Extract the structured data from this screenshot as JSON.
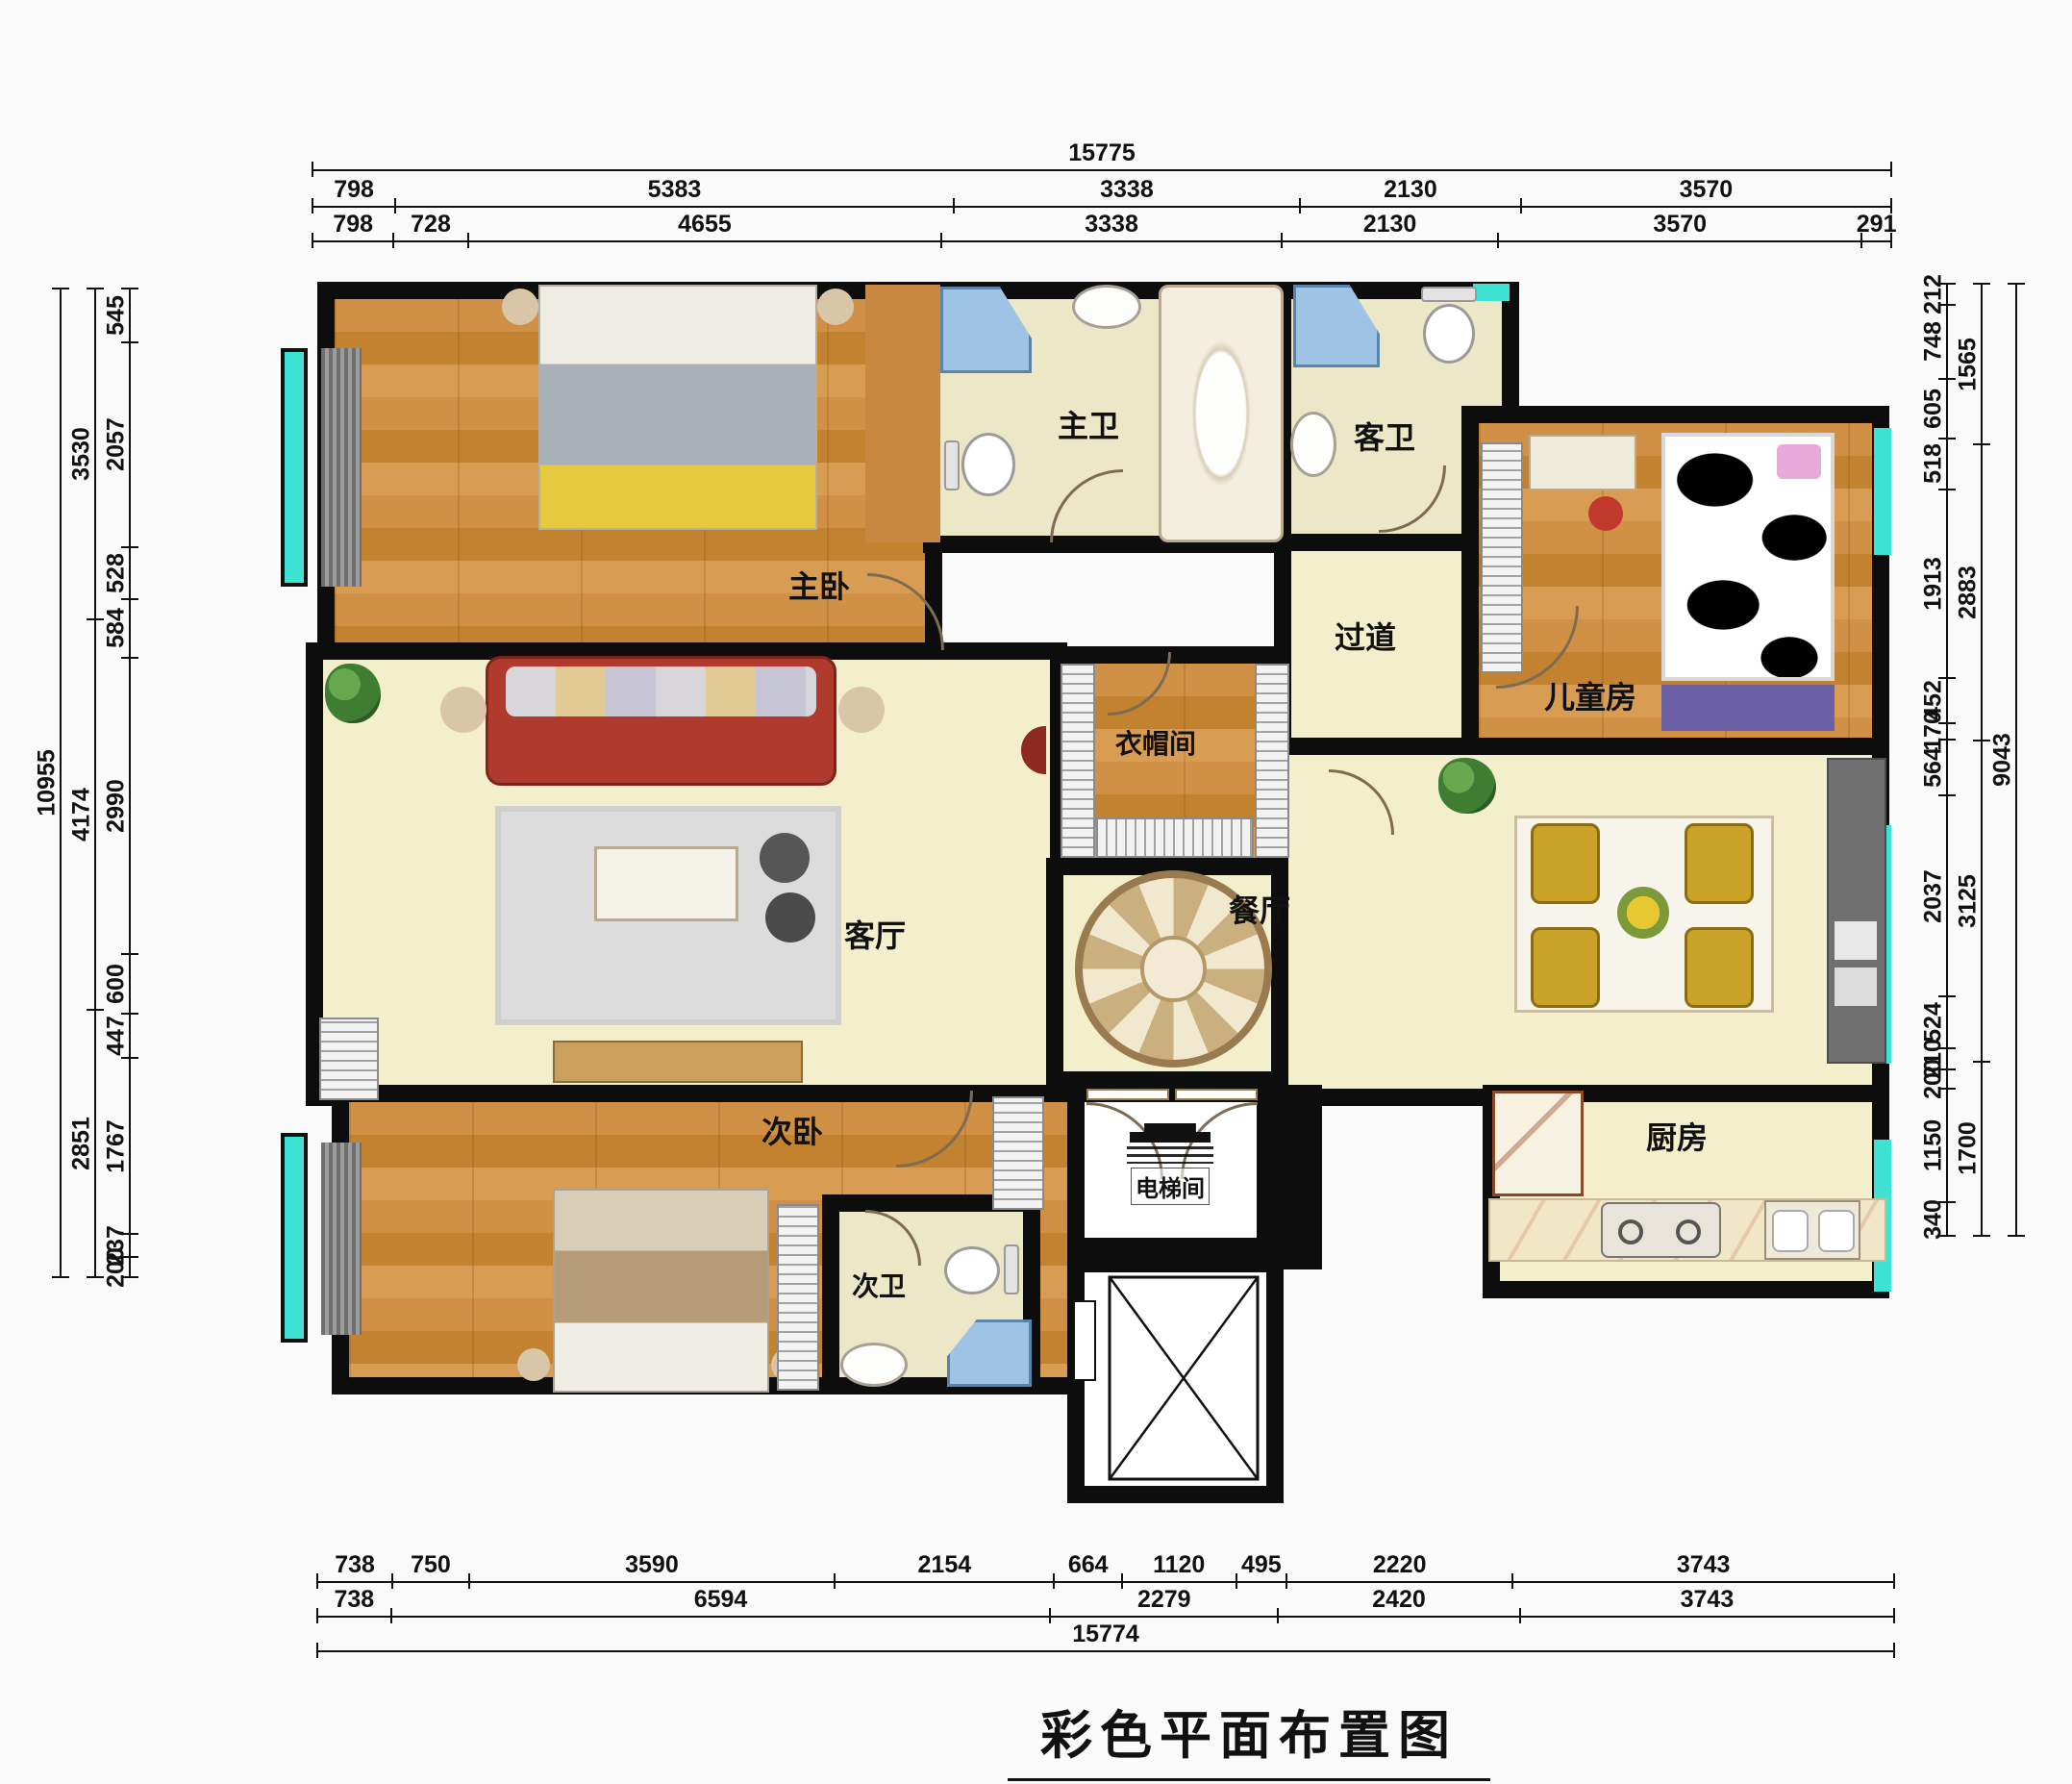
{
  "title": "彩色平面布置图",
  "rooms": {
    "master_bedroom": "主卧",
    "master_bath": "主卫",
    "guest_bath": "客卫",
    "hallway": "过道",
    "children_room": "儿童房",
    "cloakroom": "衣帽间",
    "living_room": "客厅",
    "dining_room": "餐厅",
    "second_bedroom": "次卧",
    "second_bath": "次卫",
    "kitchen": "厨房",
    "elevator_room": "电梯间"
  },
  "dimensions": {
    "top": {
      "row1": [
        15775
      ],
      "row2": [
        798,
        5383,
        3338,
        2130,
        3570
      ],
      "row3": [
        798,
        728,
        4655,
        3338,
        2130,
        3570,
        291
      ]
    },
    "bottom": {
      "row1": [
        738,
        750,
        3590,
        2154,
        664,
        1120,
        495,
        2220,
        3743
      ],
      "row2": [
        738,
        6594,
        2279,
        2420,
        3743
      ],
      "row3": [
        15774
      ]
    },
    "left": {
      "outer": [
        10955
      ],
      "middle": [
        3530,
        4174,
        2851
      ],
      "inner": [
        545,
        2057,
        528,
        584,
        2990,
        600,
        447,
        1767,
        237,
        200
      ]
    },
    "right": {
      "inner": [
        212,
        748,
        605,
        518,
        1913,
        452,
        170,
        564,
        2037,
        524,
        210,
        200,
        1150,
        340
      ],
      "middle": [
        1565,
        2883,
        3125,
        1700
      ],
      "outer": [
        9043
      ]
    }
  },
  "colors": {
    "wall": "#0d0d0d",
    "wood": "#cf8f44",
    "cream": "#f3eecb",
    "bath": "#ece7c6",
    "window": "#3fe3d3",
    "sofa": "#b03a2e",
    "chair": "#c9a227",
    "shower": "#9fc3e4",
    "dim": "#111111"
  }
}
